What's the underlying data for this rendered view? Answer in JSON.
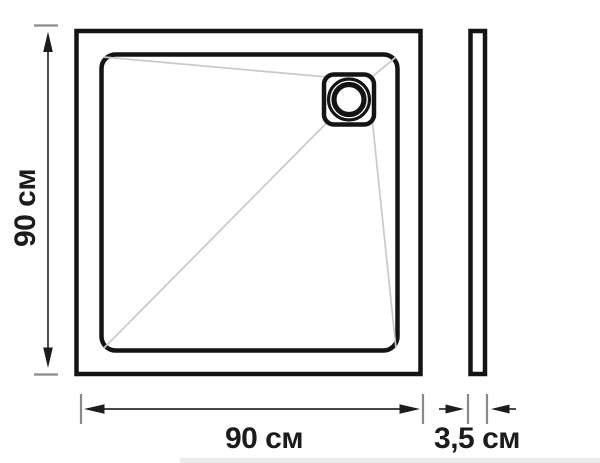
{
  "diagram": {
    "type": "technical-drawing",
    "subject": "square shower tray with corner drain, top view and side profile",
    "labels": {
      "height": "90 см",
      "width": "90 см",
      "thickness": "3,5 см"
    },
    "colors": {
      "background": "#ffffff",
      "outline": "#141414",
      "slope_line": "#c9c9c9",
      "dimension_line": "#2e2e2e",
      "tick": "#8a8a8a",
      "text": "#1c1c1c",
      "bottom_strip": "#ececec"
    }
  }
}
